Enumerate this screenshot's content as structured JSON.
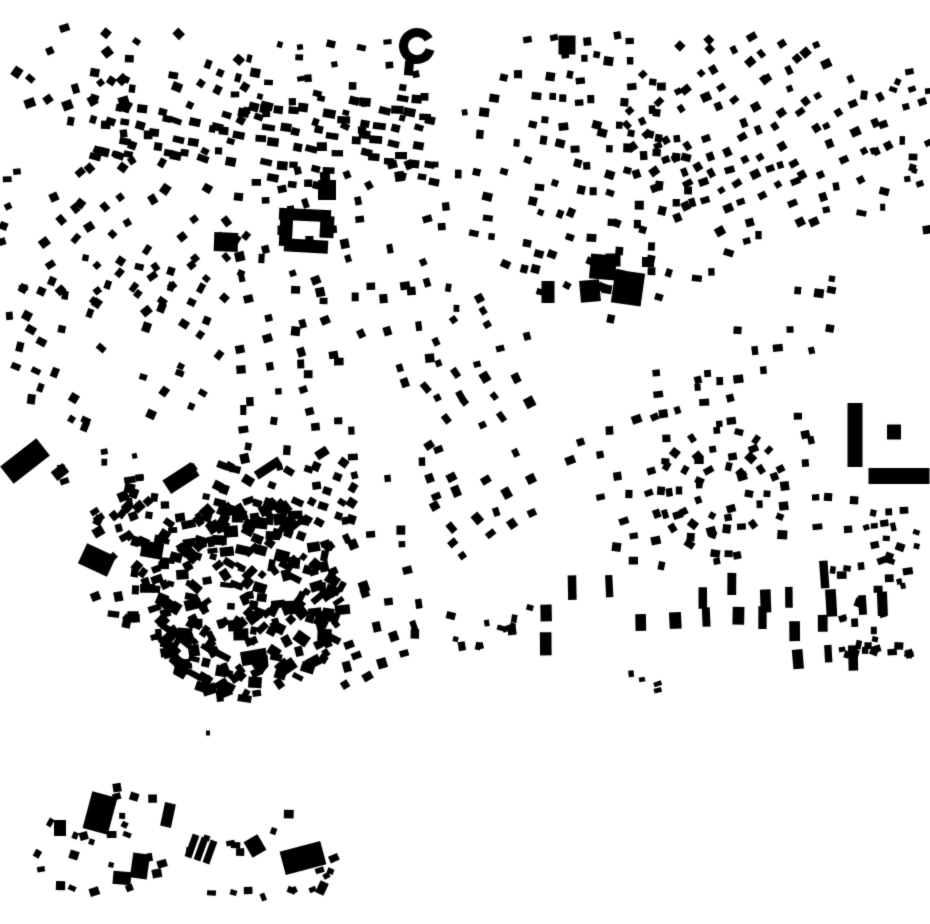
{
  "page": {
    "width": 930,
    "height": 924,
    "background": "#ffffff"
  },
  "map": {
    "kind": "building-footprint-figure-ground",
    "ink": "#000000",
    "background": "#ffffff",
    "seed": 20,
    "clusters": [
      {
        "name": "tl-corner",
        "style": "rows",
        "shape": "ellipse",
        "x": 5,
        "y": 20,
        "w": 140,
        "h": 115,
        "rowAngle": -35,
        "rowGap": 23,
        "colGap": 20,
        "jitter": 7,
        "skip": 0.38,
        "bw": [
          6,
          11
        ],
        "bh": [
          6,
          10
        ],
        "rotJitter": 45,
        "curve": 10
      },
      {
        "name": "tl-upper",
        "style": "rows",
        "shape": "ellipse",
        "x": 55,
        "y": 28,
        "w": 215,
        "h": 145,
        "rowAngle": 18,
        "rowGap": 21,
        "colGap": 17,
        "jitter": 6,
        "skip": 0.35,
        "bw": [
          6,
          10
        ],
        "bh": [
          6,
          9
        ],
        "rotJitter": 40,
        "curve": -15
      },
      {
        "name": "tl-rowband",
        "style": "rows",
        "shape": "rect",
        "x": 95,
        "y": 108,
        "w": 165,
        "h": 62,
        "rowAngle": 12,
        "rowGap": 17,
        "colGap": 12,
        "jitter": 4,
        "skip": 0.3,
        "bw": [
          8,
          13
        ],
        "bh": [
          6,
          9
        ],
        "rotJitter": 18,
        "curve": 0
      },
      {
        "name": "top-center-left",
        "style": "rows",
        "shape": "ellipse",
        "x": 225,
        "y": 22,
        "w": 215,
        "h": 120,
        "rowAngle": 5,
        "rowGap": 21,
        "colGap": 17,
        "jitter": 6,
        "skip": 0.4,
        "bw": [
          5,
          9
        ],
        "bh": [
          5,
          9
        ],
        "rotJitter": 35,
        "curve": 10
      },
      {
        "name": "upper-mid-rows",
        "style": "rows",
        "shape": "rect",
        "x": 250,
        "y": 92,
        "w": 190,
        "h": 95,
        "rowAngle": 8,
        "rowGap": 17,
        "colGap": 12,
        "jitter": 4,
        "skip": 0.32,
        "bw": [
          8,
          13
        ],
        "bh": [
          6,
          9
        ],
        "rotJitter": 16,
        "curve": -6
      },
      {
        "name": "left-band-upper",
        "style": "rows",
        "shape": "ellipse",
        "x": 15,
        "y": 140,
        "w": 245,
        "h": 175,
        "rowAngle": -45,
        "rowGap": 24,
        "colGap": 19,
        "jitter": 6,
        "skip": 0.34,
        "bw": [
          6,
          10
        ],
        "bh": [
          6,
          10
        ],
        "rotJitter": 30,
        "curve": -12
      },
      {
        "name": "left-band-lower",
        "style": "rows",
        "shape": "ellipse",
        "x": 10,
        "y": 250,
        "w": 230,
        "h": 190,
        "rowAngle": -62,
        "rowGap": 26,
        "colGap": 20,
        "jitter": 7,
        "skip": 0.36,
        "bw": [
          6,
          10
        ],
        "bh": [
          6,
          10
        ],
        "rotJitter": 30,
        "curve": 15
      },
      {
        "name": "left-edge-scatter",
        "style": "scatter",
        "shape": "rect",
        "x": 0,
        "y": 170,
        "w": 24,
        "h": 150,
        "count": 8,
        "bw": [
          5,
          9
        ],
        "bh": [
          5,
          9
        ],
        "rotJitter": 60
      },
      {
        "name": "mid-column",
        "style": "rows",
        "shape": "rect",
        "x": 235,
        "y": 160,
        "w": 195,
        "h": 330,
        "rowAngle": 80,
        "rowGap": 28,
        "colGap": 17,
        "jitter": 6,
        "skip": 0.37,
        "bw": [
          6,
          10
        ],
        "bh": [
          6,
          10
        ],
        "rotJitter": 28,
        "curve": 18
      },
      {
        "name": "center-strip",
        "style": "rows",
        "shape": "rect",
        "x": 425,
        "y": 85,
        "w": 45,
        "h": 225,
        "rowAngle": 85,
        "rowGap": 30,
        "colGap": 22,
        "jitter": 6,
        "skip": 0.5,
        "bw": [
          5,
          9
        ],
        "bh": [
          5,
          9
        ],
        "rotJitter": 30,
        "curve": 0
      },
      {
        "name": "mid-center",
        "style": "rows",
        "shape": "ellipse",
        "x": 415,
        "y": 295,
        "w": 135,
        "h": 290,
        "rowAngle": 62,
        "rowGap": 26,
        "colGap": 18,
        "jitter": 6,
        "skip": 0.36,
        "bw": [
          6,
          11
        ],
        "bh": [
          6,
          10
        ],
        "rotJitter": 26,
        "curve": -10
      },
      {
        "name": "right-top-main",
        "style": "rows",
        "shape": "ellipse",
        "x": 455,
        "y": 18,
        "w": 250,
        "h": 285,
        "rowAngle": 8,
        "rowGap": 22,
        "colGap": 16,
        "jitter": 6,
        "skip": 0.33,
        "bw": [
          6,
          10
        ],
        "bh": [
          6,
          9
        ],
        "rotJitter": 24,
        "curve": 14
      },
      {
        "name": "top-right",
        "style": "rows",
        "shape": "ellipse",
        "x": 618,
        "y": 18,
        "w": 275,
        "h": 225,
        "rowAngle": -28,
        "rowGap": 20,
        "colGap": 15,
        "jitter": 5,
        "skip": 0.32,
        "bw": [
          6,
          10
        ],
        "bh": [
          6,
          9
        ],
        "rotJitter": 22,
        "curve": 18
      },
      {
        "name": "right-edge-top",
        "style": "scatter",
        "shape": "rect",
        "x": 855,
        "y": 65,
        "w": 75,
        "h": 165,
        "count": 20,
        "bw": [
          5,
          10
        ],
        "bh": [
          5,
          9
        ],
        "rotJitter": 50
      },
      {
        "name": "right-mid",
        "style": "rows",
        "shape": "ellipse",
        "x": 595,
        "y": 225,
        "w": 250,
        "h": 170,
        "rowAngle": 4,
        "rowGap": 24,
        "colGap": 17,
        "jitter": 6,
        "skip": 0.42,
        "bw": [
          6,
          10
        ],
        "bh": [
          6,
          9
        ],
        "rotJitter": 26,
        "curve": -16
      },
      {
        "name": "right-lower",
        "style": "rows",
        "shape": "ellipse",
        "x": 535,
        "y": 370,
        "w": 310,
        "h": 205,
        "rowAngle": -10,
        "rowGap": 25,
        "colGap": 17,
        "jitter": 6,
        "skip": 0.45,
        "bw": [
          6,
          10
        ],
        "bh": [
          6,
          9
        ],
        "rotJitter": 28,
        "curve": 16
      },
      {
        "name": "ring-street",
        "style": "orbit",
        "cx": 723,
        "cy": 492,
        "radii": [
          26,
          44,
          62
        ],
        "counts": [
          9,
          14,
          18
        ],
        "bw": [
          6,
          10
        ],
        "bh": [
          6,
          9
        ],
        "rotJitter": 14,
        "skip": 0.2
      },
      {
        "name": "oldtown-upper",
        "style": "rows",
        "shape": "rect",
        "x": 205,
        "y": 455,
        "w": 160,
        "h": 90,
        "rowAngle": 22,
        "rowGap": 17,
        "colGap": 12,
        "jitter": 4,
        "skip": 0.26,
        "bw": [
          7,
          12
        ],
        "bh": [
          6,
          10
        ],
        "rotJitter": 20,
        "curve": -8
      },
      {
        "name": "oldtown-core",
        "style": "scatter",
        "shape": "ellipse",
        "x": 140,
        "y": 495,
        "w": 205,
        "h": 205,
        "count": 250,
        "bw": [
          6,
          15
        ],
        "bh": [
          5,
          12
        ],
        "rotJitter": 90
      },
      {
        "name": "oldtown-west",
        "style": "scatter",
        "shape": "ellipse",
        "x": 85,
        "y": 475,
        "w": 90,
        "h": 150,
        "count": 42,
        "bw": [
          6,
          12
        ],
        "bh": [
          5,
          10
        ],
        "rotJitter": 90
      },
      {
        "name": "oldtown-east-fringe",
        "style": "rows",
        "shape": "ellipse",
        "x": 295,
        "y": 505,
        "w": 145,
        "h": 185,
        "rowAngle": 75,
        "rowGap": 24,
        "colGap": 16,
        "jitter": 6,
        "skip": 0.36,
        "bw": [
          6,
          11
        ],
        "bh": [
          6,
          10
        ],
        "rotJitter": 26,
        "curve": -12
      },
      {
        "name": "south-center-gap",
        "style": "scatter",
        "shape": "rect",
        "x": 450,
        "y": 595,
        "w": 80,
        "h": 62,
        "count": 12,
        "bw": [
          5,
          10
        ],
        "bh": [
          5,
          9
        ],
        "rotJitter": 40
      },
      {
        "name": "south-strip",
        "style": "rows",
        "shape": "rect",
        "x": 523,
        "y": 572,
        "w": 360,
        "h": 88,
        "rowAngle": 88,
        "rowGap": 31,
        "colGap": 27,
        "jitter": 6,
        "skip": 0.4,
        "bw": [
          16,
          28
        ],
        "bh": [
          7,
          12
        ],
        "rotJitter": 6,
        "curve": 0
      },
      {
        "name": "south-strip-east",
        "style": "scatter",
        "shape": "rect",
        "x": 832,
        "y": 560,
        "w": 78,
        "h": 95,
        "count": 30,
        "bw": [
          5,
          10
        ],
        "bh": [
          5,
          9
        ],
        "rotJitter": 45
      },
      {
        "name": "right-edge-mid",
        "style": "scatter",
        "shape": "rect",
        "x": 845,
        "y": 500,
        "w": 85,
        "h": 58,
        "count": 15,
        "bw": [
          5,
          9
        ],
        "bh": [
          5,
          9
        ],
        "rotJitter": 45
      },
      {
        "name": "south-tiny",
        "style": "scatter",
        "shape": "rect",
        "x": 620,
        "y": 672,
        "w": 45,
        "h": 26,
        "count": 4,
        "bw": [
          4,
          8
        ],
        "bh": [
          4,
          7
        ],
        "rotJitter": 45
      },
      {
        "name": "industrial-scatter",
        "style": "scatter",
        "shape": "rect",
        "x": 40,
        "y": 438,
        "w": 110,
        "h": 60,
        "count": 7,
        "bw": [
          5,
          9
        ],
        "bh": [
          5,
          8
        ],
        "rotJitter": 45
      },
      {
        "name": "sw-village-west",
        "style": "scatter",
        "shape": "ellipse",
        "x": 28,
        "y": 782,
        "w": 150,
        "h": 120,
        "count": 24,
        "bw": [
          5,
          10
        ],
        "bh": [
          5,
          9
        ],
        "rotJitter": 60
      },
      {
        "name": "sw-village-east",
        "style": "scatter",
        "shape": "ellipse",
        "x": 180,
        "y": 808,
        "w": 160,
        "h": 95,
        "count": 18,
        "bw": [
          5,
          10
        ],
        "bh": [
          5,
          9
        ],
        "rotJitter": 60
      }
    ],
    "voids": [
      {
        "x": 395,
        "y": 418,
        "rx": 40,
        "ry": 36
      },
      {
        "x": 660,
        "y": 337,
        "rx": 44,
        "ry": 33
      },
      {
        "x": 558,
        "y": 332,
        "rx": 30,
        "ry": 27
      },
      {
        "x": 752,
        "y": 300,
        "rx": 44,
        "ry": 27
      }
    ],
    "landmarks": [
      {
        "type": "ring",
        "cx": 417,
        "cy": 46,
        "ro": 18,
        "ri": 9,
        "start": 15,
        "end": 330
      },
      {
        "type": "rect",
        "x": 409,
        "y": 68,
        "w": 9,
        "h": 15,
        "rot": 5
      },
      {
        "type": "rect",
        "x": 226,
        "y": 242,
        "w": 24,
        "h": 19,
        "rot": 2
      },
      {
        "type": "rect",
        "x": 305,
        "y": 215,
        "w": 52,
        "h": 12,
        "rot": 3
      },
      {
        "type": "rect",
        "x": 286,
        "y": 231,
        "w": 13,
        "h": 30,
        "rot": 3
      },
      {
        "type": "rect",
        "x": 306,
        "y": 246,
        "w": 44,
        "h": 13,
        "rot": 3
      },
      {
        "type": "rect",
        "x": 327,
        "y": 227,
        "w": 14,
        "h": 22,
        "rot": 3
      },
      {
        "type": "rect",
        "x": 327,
        "y": 190,
        "w": 18,
        "h": 20,
        "rot": 0
      },
      {
        "type": "rect",
        "x": 567,
        "y": 45,
        "w": 17,
        "h": 19,
        "rot": 0
      },
      {
        "type": "rect",
        "x": 548,
        "y": 292,
        "w": 13,
        "h": 22,
        "rot": 0
      },
      {
        "type": "rect",
        "x": 603,
        "y": 267,
        "w": 26,
        "h": 25,
        "rot": 5
      },
      {
        "type": "rect",
        "x": 590,
        "y": 291,
        "w": 20,
        "h": 22,
        "rot": -5
      },
      {
        "type": "rect",
        "x": 628,
        "y": 288,
        "w": 30,
        "h": 33,
        "rot": 8
      },
      {
        "type": "rect",
        "x": 613,
        "y": 260,
        "w": 15,
        "h": 13,
        "rot": 0
      },
      {
        "type": "rect",
        "x": 648,
        "y": 262,
        "w": 12,
        "h": 10,
        "rot": 0
      },
      {
        "type": "rect",
        "x": 855,
        "y": 435,
        "w": 15,
        "h": 64,
        "rot": 0
      },
      {
        "type": "rect",
        "x": 894,
        "y": 432,
        "w": 14,
        "h": 15,
        "rot": 0
      },
      {
        "type": "rect",
        "x": 899,
        "y": 476,
        "w": 61,
        "h": 16,
        "rot": 0
      },
      {
        "type": "rect",
        "x": 25,
        "y": 461,
        "w": 46,
        "h": 22,
        "rot": -38
      },
      {
        "type": "rect",
        "x": 60,
        "y": 472,
        "w": 15,
        "h": 11,
        "rot": -38
      },
      {
        "type": "rect",
        "x": 181,
        "y": 478,
        "w": 34,
        "h": 16,
        "rot": -33
      },
      {
        "type": "rect",
        "x": 191,
        "y": 469,
        "w": 11,
        "h": 8,
        "rot": -33
      },
      {
        "type": "rect",
        "x": 268,
        "y": 468,
        "w": 28,
        "h": 9,
        "rot": -33
      },
      {
        "type": "rect",
        "x": 322,
        "y": 453,
        "w": 13,
        "h": 9,
        "rot": -33
      },
      {
        "type": "rect",
        "x": 97,
        "y": 560,
        "w": 32,
        "h": 22,
        "rot": 25
      },
      {
        "type": "rect",
        "x": 152,
        "y": 550,
        "w": 22,
        "h": 16,
        "rot": 10
      },
      {
        "type": "ring",
        "cx": 186,
        "cy": 650,
        "ro": 15,
        "ri": 9,
        "start": 70,
        "end": 330
      },
      {
        "type": "rect",
        "x": 254,
        "y": 657,
        "w": 26,
        "h": 14,
        "rot": -10
      },
      {
        "type": "rect",
        "x": 287,
        "y": 667,
        "w": 18,
        "h": 12,
        "rot": -35
      },
      {
        "type": "rect",
        "x": 208,
        "y": 733,
        "w": 4,
        "h": 5,
        "rot": 0
      },
      {
        "type": "rect",
        "x": 100,
        "y": 813,
        "w": 26,
        "h": 38,
        "rot": 15
      },
      {
        "type": "rect",
        "x": 60,
        "y": 828,
        "w": 12,
        "h": 16,
        "rot": 0
      },
      {
        "type": "rect",
        "x": 168,
        "y": 815,
        "w": 11,
        "h": 24,
        "rot": 12
      },
      {
        "type": "rect",
        "x": 140,
        "y": 866,
        "w": 17,
        "h": 25,
        "rot": 8
      },
      {
        "type": "rect",
        "x": 122,
        "y": 878,
        "w": 18,
        "h": 13,
        "rot": 5
      },
      {
        "type": "rect",
        "x": 192,
        "y": 846,
        "w": 7,
        "h": 24,
        "rot": 20
      },
      {
        "type": "rect",
        "x": 201,
        "y": 849,
        "w": 7,
        "h": 24,
        "rot": 20
      },
      {
        "type": "rect",
        "x": 210,
        "y": 852,
        "w": 7,
        "h": 24,
        "rot": 20
      },
      {
        "type": "rect",
        "x": 255,
        "y": 846,
        "w": 16,
        "h": 18,
        "rot": -30
      },
      {
        "type": "rect",
        "x": 303,
        "y": 858,
        "w": 42,
        "h": 24,
        "rot": -15
      },
      {
        "type": "rect",
        "x": 322,
        "y": 888,
        "w": 9,
        "h": 13,
        "rot": 25
      }
    ]
  }
}
